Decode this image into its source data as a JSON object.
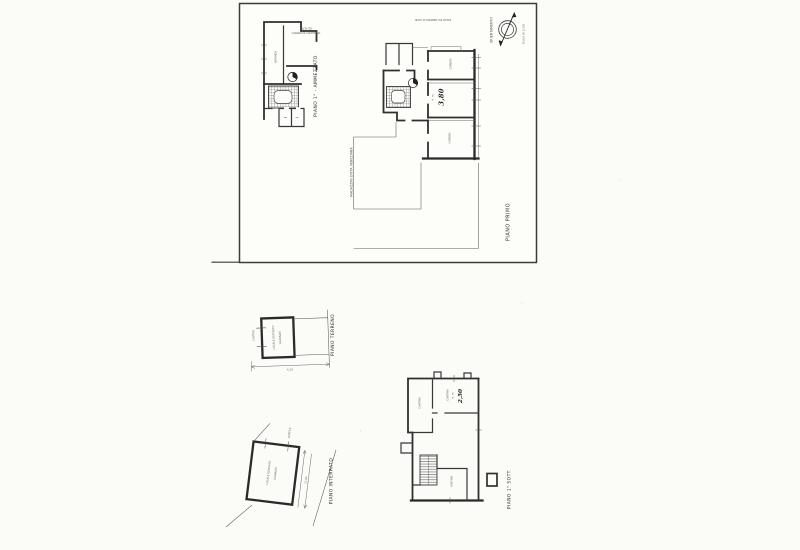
{
  "palette": {
    "paper": "#fbfbf8",
    "ink": "#2f2f2f",
    "ink_light": "#5a5a5a"
  },
  "sheet": {
    "compass": {
      "orientation_label": "ORIENTAMENTO",
      "scale_label": "SCALA DI 1:200"
    },
    "mezzanine_plan": {
      "title": "PIANO 1° - AMMEZZATO",
      "note_line1": "TERRAZZO SCOPERTO",
      "note_line2": "ED ALTRI",
      "room_label": "VERANDA"
    },
    "first_floor_plan": {
      "title": "PIANO PRIMO",
      "boundary_note": "SALVO ED ANNESSI DI ALTRI",
      "courtyard_note": "MAGAZZINI DITTA VENEZIANA",
      "room_a_label": "CAMERA",
      "room_b_height_label": "h. m.",
      "room_b_height_value": "3,80",
      "room_c_label": "CAMERA"
    }
  },
  "ground_floor_plan": {
    "title": "PIANO TERRENO",
    "room_label_line1": "LOCALE DEPOSITO",
    "room_label_line2": "(GARAGE)",
    "courtyard_label": "CORTILE",
    "dimension": "6.10"
  },
  "basement_plan": {
    "title": "PIANO INTERRATO",
    "room_label_line1": "LOCALE DEPOSITO",
    "room_label_line2": "(GARAGE)",
    "courtyard_label": "CORTILE",
    "dimension": "12.04"
  },
  "cellar_plan": {
    "title": "PIANO 1° SOTT.",
    "room_left_label": "CANTINA",
    "room_right_label": "CANTINA",
    "room_right_height_label": "h. m.",
    "room_right_height_value": "2,50",
    "room_bottom_label": "CANTINA"
  }
}
